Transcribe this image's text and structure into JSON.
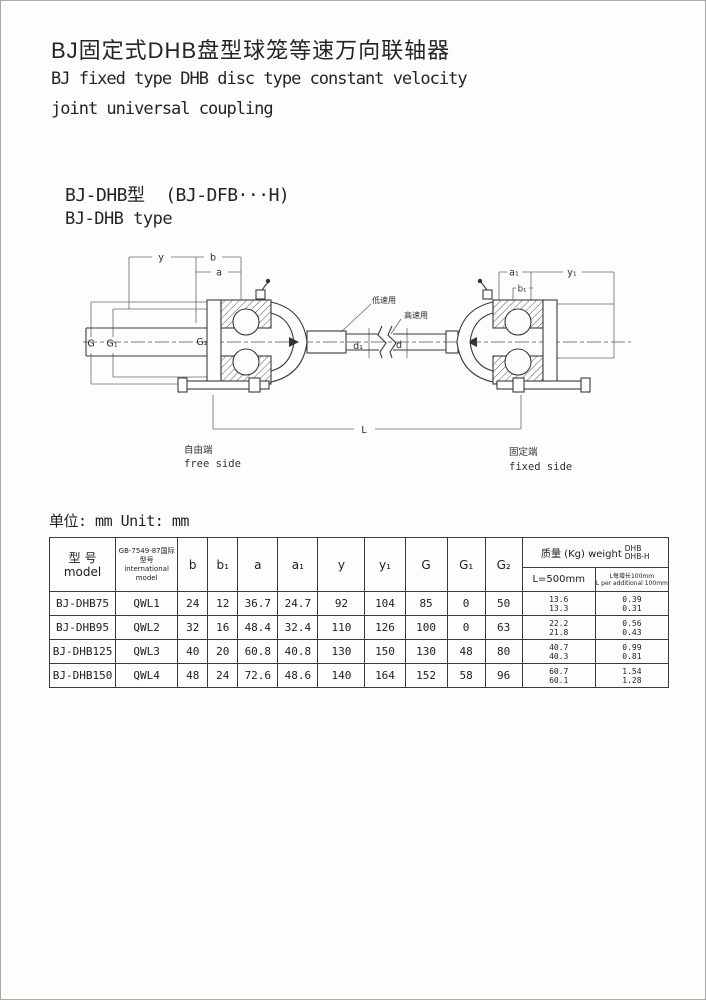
{
  "page": {
    "title_zh": "BJ固定式DHB盘型球笼等速万向联轴器",
    "title_en_line1": "BJ fixed type DHB disc type constant velocity",
    "title_en_line2": "joint universal coupling",
    "type_label_zh": "BJ-DHB型  (BJ-DFB···H)",
    "type_label_en": "BJ-DHB type",
    "unit_note": "单位: mm Unit: mm",
    "ink_color": "#2b2b2b",
    "paper_color": "#fdfdfc"
  },
  "drawing": {
    "dim_labels": {
      "y": "y",
      "b": "b",
      "a": "a",
      "a1": "a₁",
      "b1": "b₁",
      "y1": "y₁",
      "G": "G",
      "G1": "G₁",
      "G2": "G₂",
      "d1": "d₁",
      "d": "d",
      "L": "L"
    },
    "annotations": {
      "low_speed": "低速用",
      "high_speed": "高速用",
      "free_side_zh": "自由端",
      "free_side_en": "free side",
      "fixed_side_zh": "固定端",
      "fixed_side_en": "fixed side"
    }
  },
  "table": {
    "headers": {
      "model_zh": "型 号",
      "model_en": "model",
      "intl_zh": "GB-7549-87国际型号",
      "intl_en": "international model",
      "dims": [
        "b",
        "b₁",
        "a",
        "a₁",
        "y",
        "y₁",
        "G",
        "G₁",
        "G₂"
      ],
      "weight_label": "质量 (Kg) weight",
      "weight_type_top": "DHB",
      "weight_type_bottom": "DHB-H",
      "sub_l500": "L=500mm",
      "sub_per_zh": "L每增长100mm",
      "sub_per_en": "L per additional 100mm"
    },
    "rows": [
      {
        "model": "BJ-DHB75",
        "intl": "QWL1",
        "b": "24",
        "b1": "12",
        "a": "36.7",
        "a1": "24.7",
        "y": "92",
        "y1": "104",
        "G": "85",
        "G1": "0",
        "G2": "50",
        "w500": [
          "13.6",
          "13.3"
        ],
        "wadd": [
          "0.39",
          "0.31"
        ]
      },
      {
        "model": "BJ-DHB95",
        "intl": "QWL2",
        "b": "32",
        "b1": "16",
        "a": "48.4",
        "a1": "32.4",
        "y": "110",
        "y1": "126",
        "G": "100",
        "G1": "0",
        "G2": "63",
        "w500": [
          "22.2",
          "21.8"
        ],
        "wadd": [
          "0.56",
          "0.43"
        ]
      },
      {
        "model": "BJ-DHB125",
        "intl": "QWL3",
        "b": "40",
        "b1": "20",
        "a": "60.8",
        "a1": "40.8",
        "y": "130",
        "y1": "150",
        "G": "130",
        "G1": "48",
        "G2": "80",
        "w500": [
          "40.7",
          "40.3"
        ],
        "wadd": [
          "0.99",
          "0.81"
        ]
      },
      {
        "model": "BJ-DHB150",
        "intl": "QWL4",
        "b": "48",
        "b1": "24",
        "a": "72.6",
        "a1": "48.6",
        "y": "140",
        "y1": "164",
        "G": "152",
        "G1": "58",
        "G2": "96",
        "w500": [
          "60.7",
          "60.1"
        ],
        "wadd": [
          "1.54",
          "1.28"
        ]
      }
    ]
  }
}
